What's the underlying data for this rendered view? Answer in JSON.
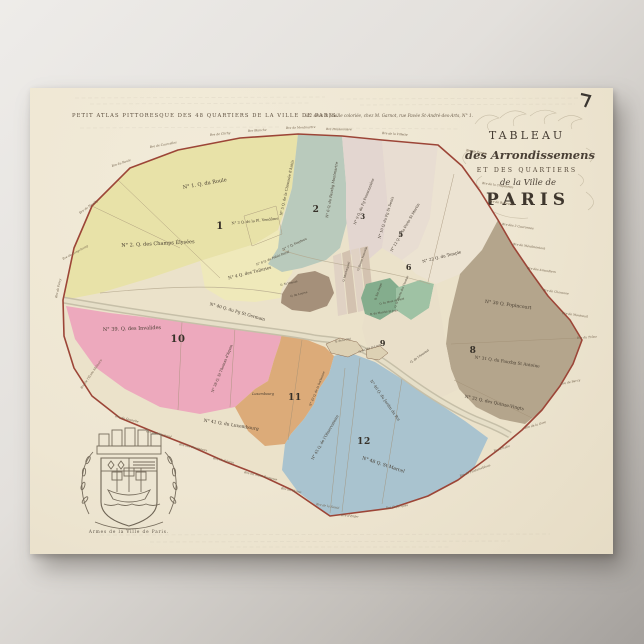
{
  "poster": {
    "header_left": "PETIT ATLAS PITTORESQUE DES 48 QUARTIERS DE LA VILLE DE PARIS.",
    "imprint": "à 2 sous la feuille coloriée, chez M. Garnot, rue Pavée St-André-des-Arts, N° 1.",
    "title": {
      "line1": "TABLEAU",
      "line2": "des Arrondissemens",
      "line3": "ET DES QUARTIERS",
      "line4": "de la Ville de",
      "line5": "PARIS"
    },
    "arms_caption": "Armes de la Ville de Paris."
  },
  "map": {
    "colors": {
      "paper": "#f0e8d5",
      "map_base": "#ebe2ca",
      "wall": "#9c4537",
      "arr1": "#e8e2a8",
      "arr1b": "#efe9ba",
      "arr2": "#b9cabc",
      "arr3": "#e3d6d0",
      "arr5": "#e8ddd2",
      "arr6": "#ece3d2",
      "arr7a": "#84ad8d",
      "arr7b": "#9fc2a4",
      "arr4": "#a5907a",
      "arr8": "#b4a58c",
      "arr9": "#e9dfc9",
      "arr10": "#eda9bd",
      "arr11": "#dcab79",
      "arr12": "#a9c3cf",
      "river": "#c6bfa8",
      "river_inner": "#e6dfc8",
      "island": "#ddd1b4",
      "strip1": "#e0d2c4",
      "strip2": "#d3c2b0"
    },
    "arrondissement_numbers": [
      "1",
      "2",
      "3",
      "5",
      "6",
      "8",
      "9",
      "10",
      "11",
      "12"
    ],
    "quartier_labels": [
      "N° 1. Q. du Roule",
      "N° 2. Q. des Champs Élysées",
      "N° 3 Q. de la Pl. Vendôme",
      "N° 4 Q. des Tuileries",
      "N° 8 Q. du Palais Royal",
      "N° 7 Q. Feydeau",
      "N° 5 Q. de la Chaussée d'Antin",
      "N° 6 Q. du Fauxbg Montmartre",
      "N° 9 Q. du Fg Poissonnière",
      "N° 10 Q. du Fg St Denis",
      "N° 12 Q. de la Porte St Martin",
      "N° 22 Q. du Temple",
      "N° 30 Q. Popincourt",
      "N° 31 Q. du Fauxbg St Antoine",
      "N° 32 Q. des Quinze-Vingts",
      "N° 39. Q. des Invalides",
      "N° 40 Q. du Fg St Germain",
      "N° 38 Q. St Thomas d'Aquin",
      "N° 41 Q. du Luxembourg",
      "Luxembourg",
      "N° 43 Q. de la Sorbonne",
      "N° 45 Q. de l'Observatoire",
      "N° 46 Q. du Jardin du Roi",
      "N° 48 Q. St Marcel",
      "Q. Ste Avoye",
      "Q. du Marché St Jean",
      "Q. St Honoré",
      "Q. du Louvre",
      "Q. de la Cité",
      "Q. de l'Arsenal",
      "Q. Montorgueil",
      "Q. Bonne Nouvelle",
      "Q. St Martin des Champs",
      "Q. du Mont de Piété",
      "Q. de l'Île St Louis"
    ],
    "barrier_labels": [
      "Bre de Passy",
      "Bre de Longchamp",
      "Bre de Neuilly",
      "Bre du Roule",
      "Bre de Courcelles",
      "Bre de Clichy",
      "Bre Blanche",
      "Bre de Montmartre",
      "Bre Poissonnière",
      "Bre de la Villette",
      "Bre de Pantin",
      "Bre de la Chopinette",
      "Bre de Belleville",
      "Bre des 3 Couronnes",
      "Bre de Ménilmontant",
      "Bre des Amandiers",
      "Bre de Charonne",
      "Bre de Montreuil",
      "Bre du Trône",
      "Bre de Bercy",
      "Bre de la Gare",
      "Bre d'Italie",
      "Bre de Fontainebleau",
      "Bre St Jacques",
      "Bre d'Enfer",
      "Bre de la Santé",
      "Bre du Maine",
      "Bre du Mont Parnasse",
      "Bre de Sèvres",
      "Bre des Fourneaux",
      "Bre de Vaugirard",
      "Bre de Grenelle",
      "Bre de l'École Militaire"
    ]
  }
}
